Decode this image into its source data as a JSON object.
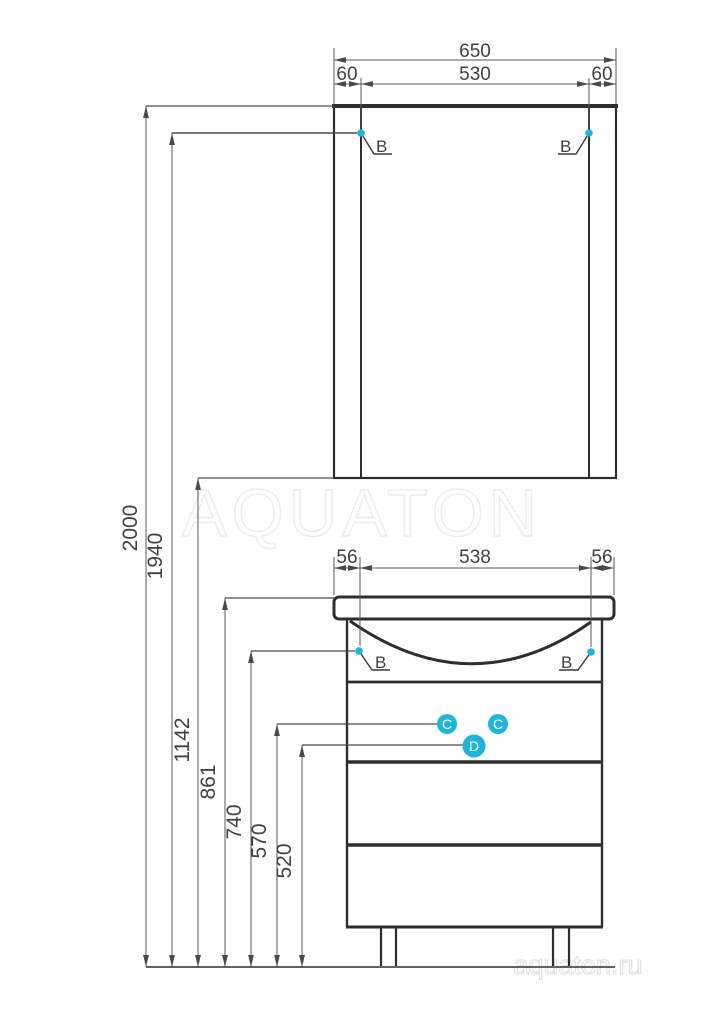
{
  "colors": {
    "accent_cyan": "#1fb4d8",
    "line_dark": "#2e2e2e",
    "line_thin": "#5a5a5a",
    "text": "#414141",
    "watermark": "#ececec"
  },
  "watermarks": {
    "brand": "AQUATON",
    "site": "aquaton.ru"
  },
  "mirror_cabinet": {
    "width_total": "650",
    "width_left_offset": "60",
    "width_center": "530",
    "width_right_offset": "60",
    "mount_point_left": "B",
    "mount_point_right": "B"
  },
  "vanity": {
    "width_left_offset": "56",
    "width_center": "538",
    "width_right_offset": "56",
    "mount_point_left": "B",
    "mount_point_right": "B",
    "fitting_c1": "C",
    "fitting_c2": "C",
    "fitting_d": "D"
  },
  "heights": {
    "mirror_top": "2000",
    "mirror_mount": "1940",
    "mirror_bottom": "1142",
    "vanity_top": "861",
    "vanity_mount": "740",
    "fitting_c": "570",
    "fitting_d": "520"
  }
}
